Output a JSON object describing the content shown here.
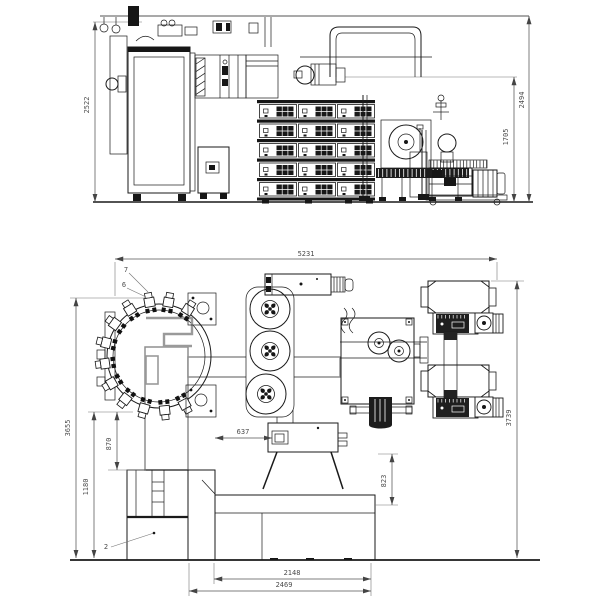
{
  "drawing": {
    "colors": {
      "background": "#ffffff",
      "line": "#1a1a1a",
      "dimension": "#555555",
      "duct": "#8f8f8f"
    },
    "side_view": {
      "dims": {
        "overall_height": "2522",
        "total_height": "2494",
        "pump_line_height": "1705"
      },
      "rack": {
        "rows": 5,
        "columns": 3
      }
    },
    "plan_view": {
      "dims": {
        "overall_length": "5231",
        "overall_depth_left": "3655",
        "base_front_depth": "1180",
        "column_front_depth": "870",
        "stand_offset": "637",
        "stand_to_base": "823",
        "base_length_inner": "2148",
        "base_length_outer": "2469",
        "overall_depth_right": "3739"
      },
      "part_labels": [
        "7",
        "6",
        "2"
      ],
      "chamber_gun_count": 12
    }
  }
}
